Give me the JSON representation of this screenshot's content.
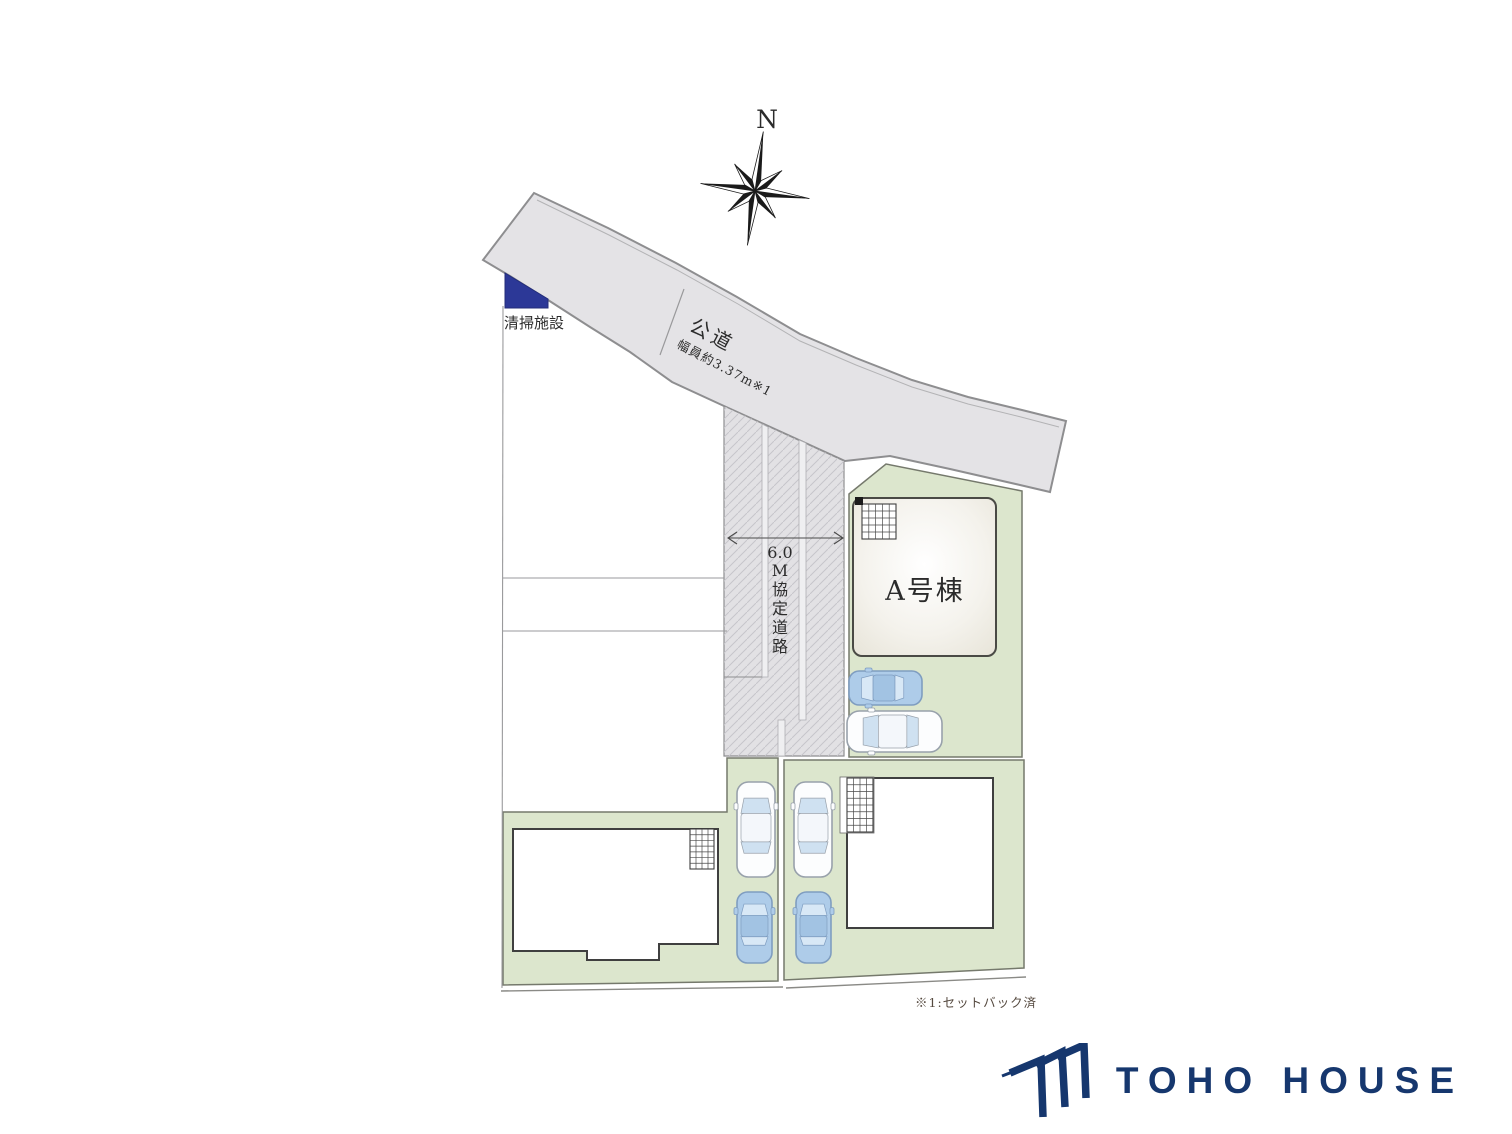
{
  "compass": {
    "north_label": "N"
  },
  "labels": {
    "cleaning_facility": "清掃施設",
    "public_road": "公道",
    "public_road_width": "幅員約3.37m※1",
    "agreement_road": "6.0M協定道路",
    "agreement_road_chars": [
      "6.0",
      "M",
      "協",
      "定",
      "道",
      "路"
    ],
    "building_a": "A号棟",
    "note": "※1:セットバック済"
  },
  "footer": {
    "brand": "TOHO HOUSE"
  },
  "colors": {
    "road_fill": "#e4e3e6",
    "road_border": "#8e8e90",
    "hatch_line": "#c6c5ca",
    "plot_fill": "#dce6cd",
    "plot_border": "#75796c",
    "building_fill": "#ffffff",
    "building_border": "#3f3f3f",
    "facility_blue": "#2c3897",
    "brand_navy": "#16376e",
    "car_white_body": "#fcfdfe",
    "car_white_edge": "#98a1ab",
    "car_blue_body": "#aecce9",
    "car_blue_edge": "#7f9dc0",
    "car_glass": "#cfe1f1"
  },
  "cars": [
    {
      "id": "car-a-blue",
      "color": "blue",
      "orientation": "left",
      "x": 849,
      "y": 671,
      "w": 73,
      "h": 34
    },
    {
      "id": "car-a-white",
      "color": "white",
      "orientation": "left",
      "x": 847,
      "y": 711,
      "w": 95,
      "h": 41
    },
    {
      "id": "car-b-white",
      "color": "white",
      "orientation": "up",
      "x": 737,
      "y": 782,
      "w": 38,
      "h": 95
    },
    {
      "id": "car-b-blue",
      "color": "blue",
      "orientation": "up",
      "x": 737,
      "y": 892,
      "w": 35,
      "h": 71
    },
    {
      "id": "car-c-white",
      "color": "white",
      "orientation": "up",
      "x": 794,
      "y": 782,
      "w": 38,
      "h": 95
    },
    {
      "id": "car-c-blue",
      "color": "blue",
      "orientation": "up",
      "x": 796,
      "y": 892,
      "w": 35,
      "h": 71
    }
  ]
}
